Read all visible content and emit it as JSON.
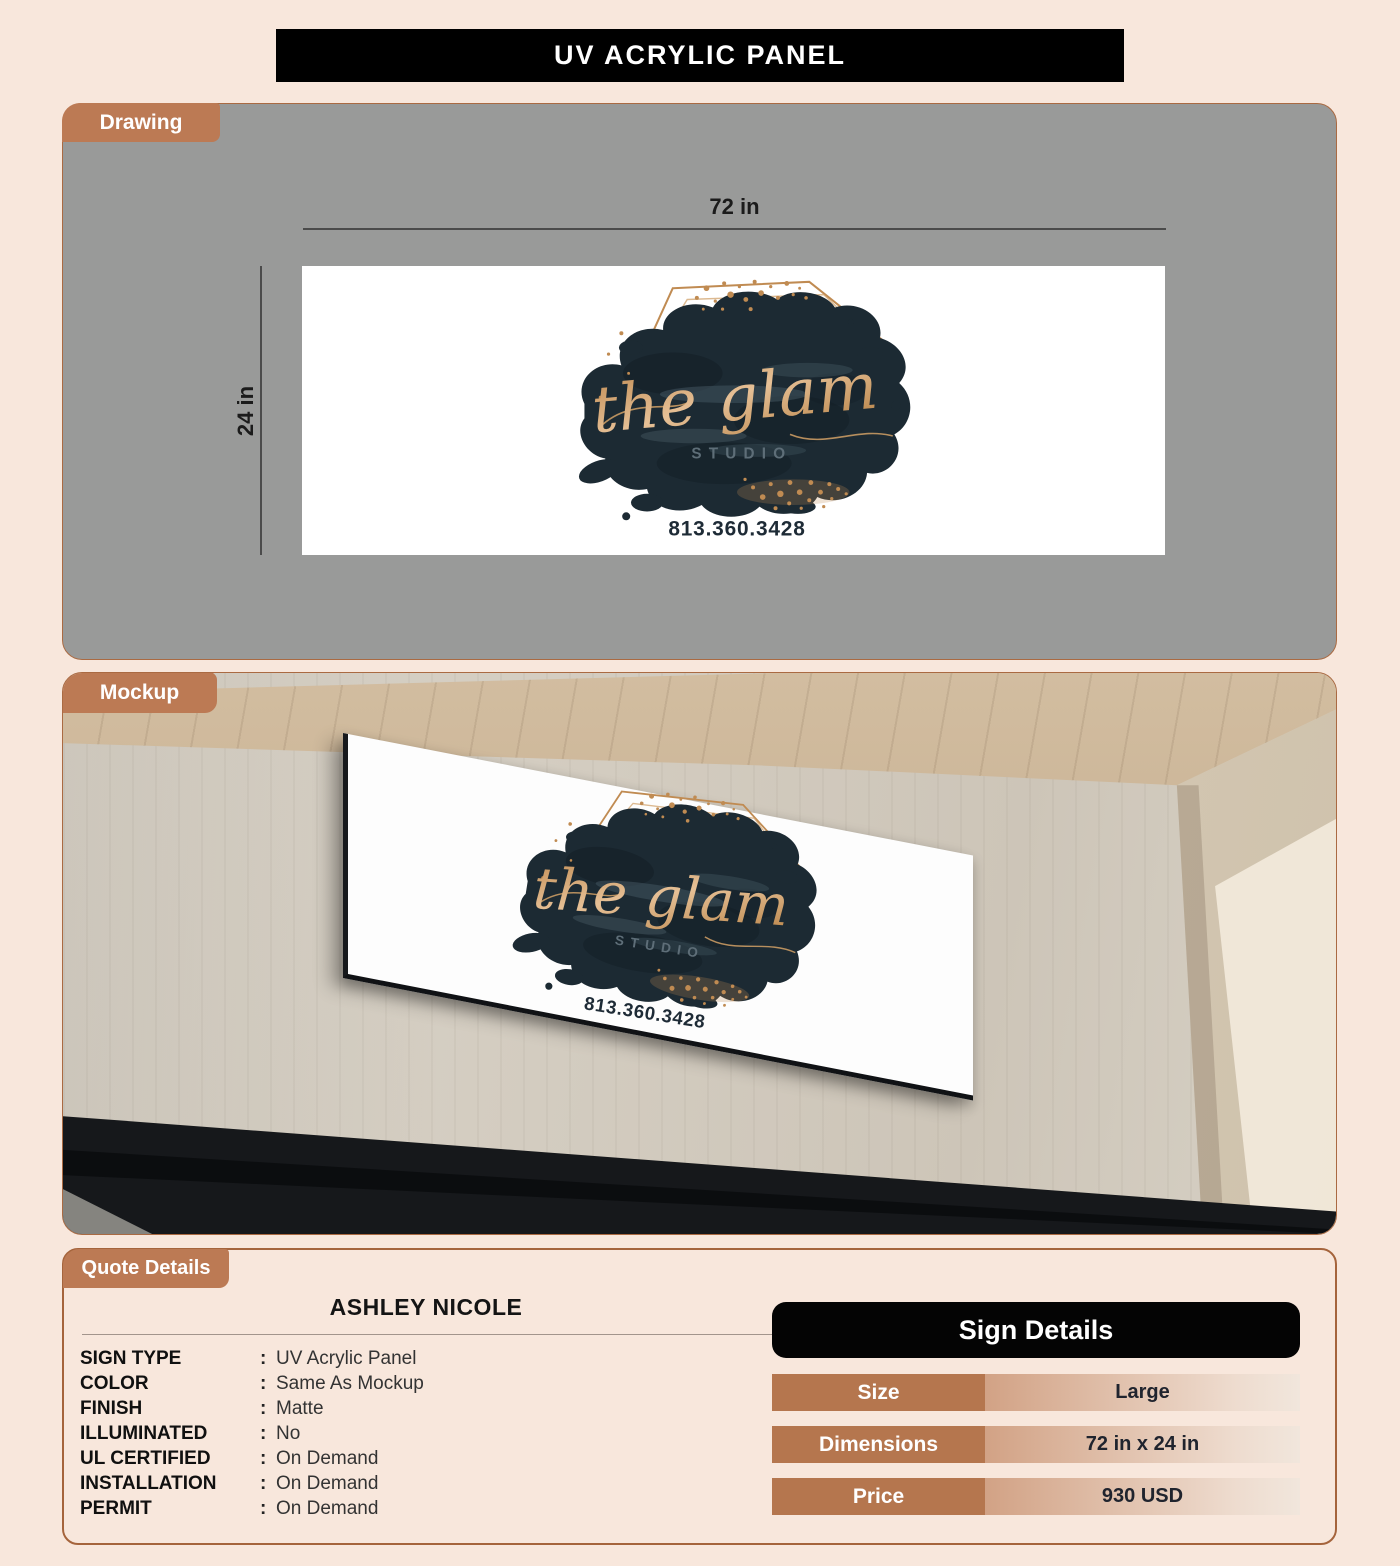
{
  "title": "UV ACRYLIC PANEL",
  "drawing": {
    "tab": "Drawing",
    "width_label": "72 in",
    "height_label": "24 in"
  },
  "mockup": {
    "tab": "Mockup"
  },
  "logo": {
    "name": "the glam",
    "subtitle": "STUDIO",
    "phone": "813.360.3428"
  },
  "quote": {
    "tab": "Quote Details",
    "customer": "ASHLEY NICOLE",
    "separator": ":",
    "fields": [
      {
        "label": "SIGN TYPE",
        "value": "UV Acrylic Panel"
      },
      {
        "label": "COLOR",
        "value": "Same As Mockup"
      },
      {
        "label": "FINISH",
        "value": "Matte"
      },
      {
        "label": "ILLUMINATED",
        "value": "No"
      },
      {
        "label": "UL CERTIFIED",
        "value": "On Demand"
      },
      {
        "label": "INSTALLATION",
        "value": "On Demand"
      },
      {
        "label": "PERMIT",
        "value": "On Demand"
      }
    ]
  },
  "sign_details": {
    "header": "Sign Details",
    "rows": [
      {
        "label": "Size",
        "value": "Large"
      },
      {
        "label": "Dimensions",
        "value": "72 in x 24 in"
      },
      {
        "label": "Price",
        "value": "930 USD"
      }
    ]
  },
  "colors": {
    "accent": "#bc7a54",
    "panel_gray": "#999a99",
    "banner_bg": "#000000",
    "gold": "#c08b52",
    "ink_blob": "#1c2a33",
    "page_bg": "#f8e7dc"
  }
}
